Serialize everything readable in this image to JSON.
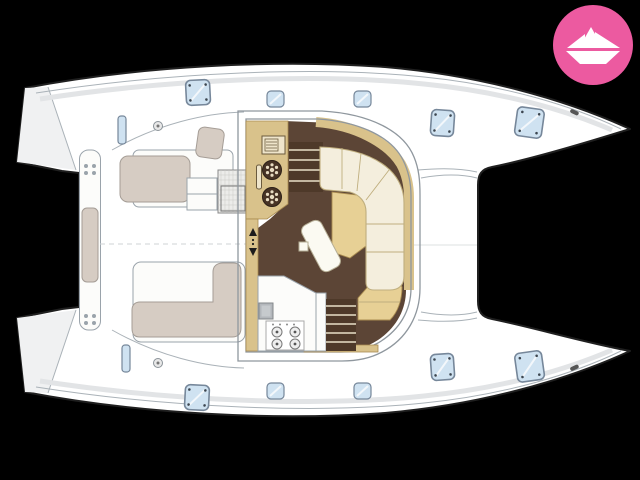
{
  "meta": {
    "title": "Catamaran sailboat deck and salon floor plan",
    "image_type": "boat-floorplan-listing-photo"
  },
  "colors": {
    "background": "#000000",
    "hull_white": "#ffffff",
    "hull_outline": "#1f1f1f",
    "deck_line": "#aab2b8",
    "deck_line_soft": "#e2e4e6",
    "deck_shade": "#f0f1f2",
    "roof_line": "#8f979e",
    "hatch_glass": "#cfe2f1",
    "hatch_frame": "#76879a",
    "hatch_dot": "#3c4650",
    "galley_tan": "#d9c28b",
    "galley_tan_dark": "#a98b50",
    "floor_brown": "#5c4536",
    "stair_brown": "#4e3929",
    "stair_line": "#e9dfc8",
    "sofa_cream": "#f4eedd",
    "sofa_edge": "#bfae7e",
    "table_tan": "#e7d095",
    "table_white": "#fbfaf2",
    "cushion_taupe": "#d6ccc3",
    "cushion_edge": "#a59d96",
    "counter_white": "#fcfcfa",
    "sink_gray": "#b3b7bb",
    "appliance_line": "#6b5b3e",
    "logo_pink": "#ec5aa0",
    "logo_white": "#ffffff"
  },
  "logo": {
    "name": "paper-boat-badge",
    "shape": "pink circle with white origami paper boat"
  },
  "boat": {
    "orientation": "bows pointing right, sterns left",
    "hull_count": 2,
    "fixtures": {
      "foredeck": [
        "trampoline between bows"
      ],
      "deck_hatches": {
        "top_hull": 5,
        "bottom_hull": 5
      },
      "cockpit": [
        "aft bench with cushion",
        "port bench with cushion",
        "starboard L-shaped bench with cushion",
        "entry steps",
        "grated cockpit table",
        "side windows",
        "deck fillers"
      ],
      "salon": [
        "galley counter with twin round sinks",
        "microwave",
        "companionway stairs to port hull",
        "companionway stairs to starboard hull",
        "L-shaped cream sofa",
        "tan dining table",
        "rotated white coffee table",
        "aft galley counter with 4-burner stove and square sink",
        "companionway up-down arrows"
      ]
    }
  }
}
